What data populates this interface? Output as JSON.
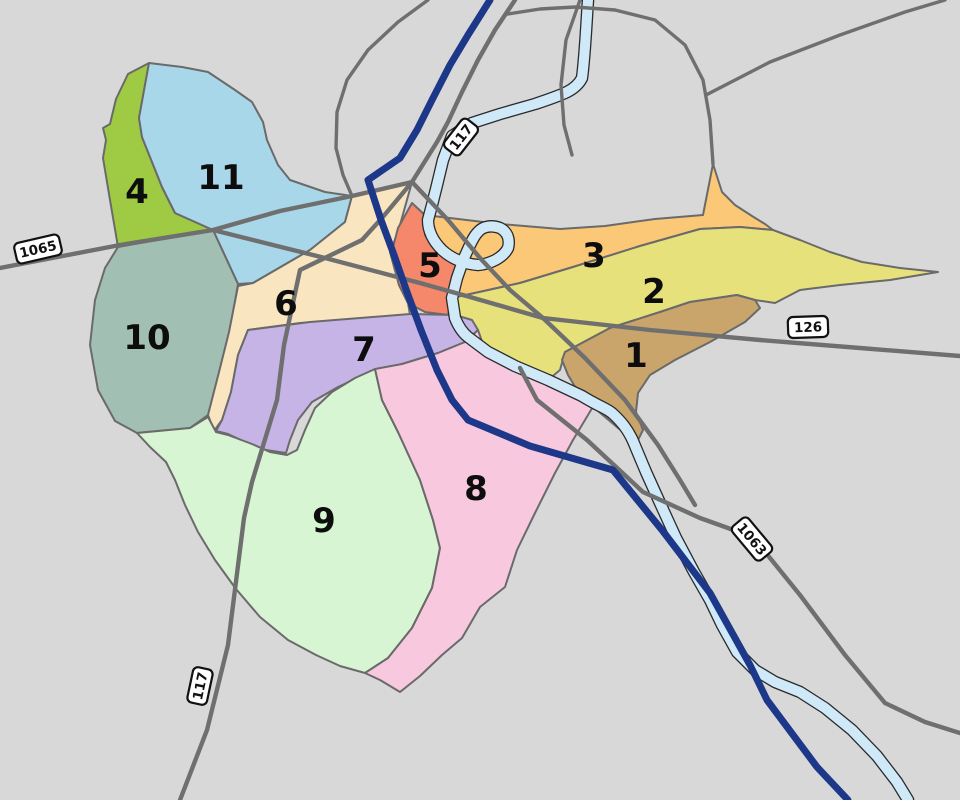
{
  "map": {
    "background_color": "#d8d8d8",
    "river_color": "#cfe9f8",
    "road_color": "#6f6f6f",
    "highway_color": "#1d3789",
    "districts": [
      {
        "number": "1",
        "color": "#c9a56b"
      },
      {
        "number": "2",
        "color": "#e7e17c"
      },
      {
        "number": "3",
        "color": "#fbc877"
      },
      {
        "number": "4",
        "color": "#9ecb43"
      },
      {
        "number": "5",
        "color": "#f5876b"
      },
      {
        "number": "6",
        "color": "#f9e5c0"
      },
      {
        "number": "7",
        "color": "#c7b4e6"
      },
      {
        "number": "8",
        "color": "#f8c8df"
      },
      {
        "number": "9",
        "color": "#d7f5d2"
      },
      {
        "number": "10",
        "color": "#a2bfb4"
      },
      {
        "number": "11",
        "color": "#a9d7ea"
      }
    ],
    "route_shields": [
      {
        "route": "1065"
      },
      {
        "route": "117"
      },
      {
        "route": "126"
      },
      {
        "route": "1063"
      },
      {
        "route": "117"
      }
    ]
  }
}
